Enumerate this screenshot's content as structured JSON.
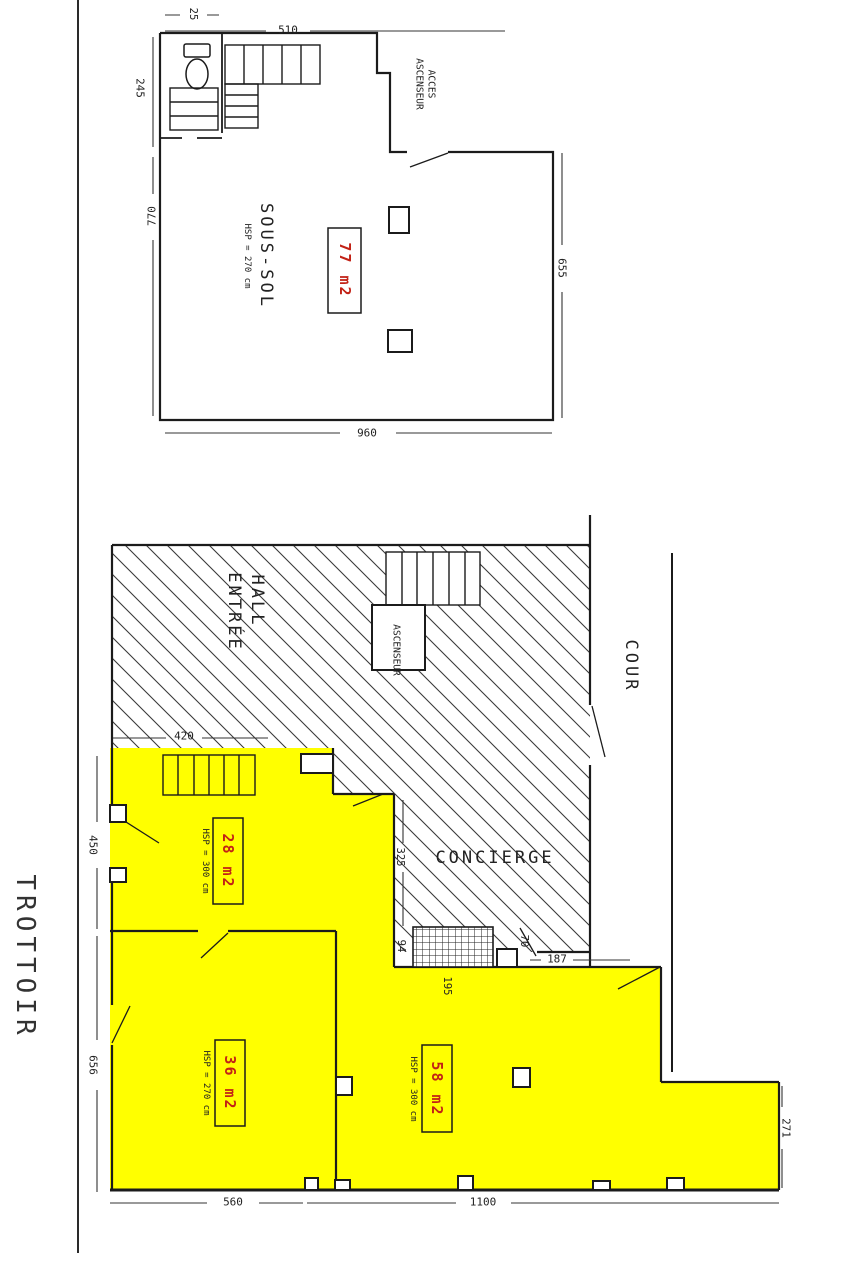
{
  "colors": {
    "room_fill": "#FFFF00",
    "area_text": "#C22216",
    "wall": "#1B1B1B"
  },
  "basement": {
    "name": "SOUS-SOL",
    "hsp": "HSP = 270 cm",
    "area": "77 m2",
    "access_line1": "ACCES",
    "access_line2": "ASCENSEUR",
    "dims": {
      "toilet": "25",
      "top": "510",
      "left_upper": "245",
      "left_lower": "770",
      "right": "655",
      "bottom": "960"
    }
  },
  "ground": {
    "hall_line1": "HALL",
    "hall_line2": "ENTRÉE",
    "elevator": "ASCENSEUR",
    "concierge": "CONCIERGE",
    "court": "COUR",
    "sidewalk": "TROTTOIR",
    "rooms": {
      "r28": {
        "area": "28 m2",
        "hsp": "HSP = 300 cm"
      },
      "r36": {
        "area": "36 m2",
        "hsp": "HSP = 270 cm"
      },
      "r58": {
        "area": "58 m2",
        "hsp": "HSP = 300 cm"
      }
    },
    "dims": {
      "hall_w": "420",
      "left_upper": "450",
      "left_lower": "656",
      "bottom_left": "560",
      "bottom_right": "1100",
      "right_ext": "271",
      "concierge_h": "325",
      "grid_w": "94",
      "door": "70",
      "court_gap": "187",
      "grid_l": "195"
    }
  }
}
